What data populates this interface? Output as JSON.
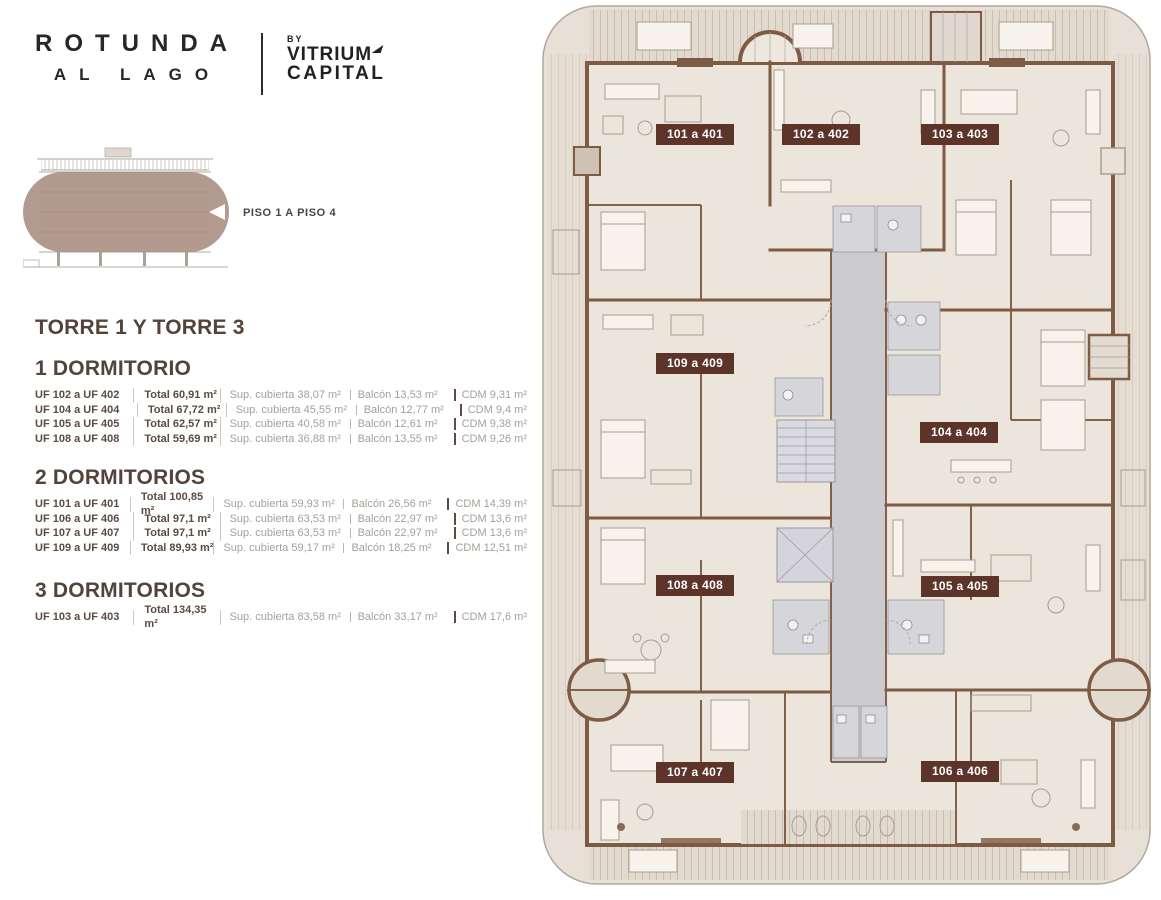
{
  "brand": {
    "name_line1": "ROTUNDA",
    "name_line2": "AL LAGO",
    "by": "BY",
    "partner_line1": "VITRIUM",
    "partner_line2": "CAPITAL"
  },
  "elevation": {
    "floor_range_label": "PISO 1 A PISO 4"
  },
  "tower_title": "TORRE 1 Y TORRE 3",
  "sections": [
    {
      "title": "1 DORMITORIO",
      "rows": [
        {
          "unit": "UF 102 a UF 402",
          "total": "Total 60,91 m²",
          "cubierta": "Sup. cubierta 38,07 m²",
          "balcon": "Balcón 13,53 m²",
          "cdm": "CDM 9,31 m²"
        },
        {
          "unit": "UF 104 a UF 404",
          "total": "Total 67,72 m²",
          "cubierta": "Sup. cubierta 45,55 m²",
          "balcon": "Balcón 12,77 m²",
          "cdm": "CDM 9,4 m²"
        },
        {
          "unit": "UF 105 a UF 405",
          "total": "Total 62,57 m²",
          "cubierta": "Sup. cubierta 40,58 m²",
          "balcon": "Balcón 12,61 m²",
          "cdm": "CDM 9,38 m²"
        },
        {
          "unit": "UF 108 a UF 408",
          "total": "Total 59,69 m²",
          "cubierta": "Sup. cubierta 36,88 m²",
          "balcon": "Balcón 13,55 m²",
          "cdm": "CDM 9,26 m²"
        }
      ]
    },
    {
      "title": "2 DORMITORIOS",
      "rows": [
        {
          "unit": "UF 101 a UF 401",
          "total": "Total 100,85 m²",
          "cubierta": "Sup. cubierta 59,93 m²",
          "balcon": "Balcón 26,56 m²",
          "cdm": "CDM 14,39 m²"
        },
        {
          "unit": "UF 106 a UF 406",
          "total": "Total 97,1 m²",
          "cubierta": "Sup. cubierta 63,53 m²",
          "balcon": "Balcón 22,97 m²",
          "cdm": "CDM 13,6 m²"
        },
        {
          "unit": "UF 107 a UF 407",
          "total": "Total 97,1 m²",
          "cubierta": "Sup. cubierta 63,53 m²",
          "balcon": "Balcón 22,97 m²",
          "cdm": "CDM 13,6 m²"
        },
        {
          "unit": "UF 109 a UF 409",
          "total": "Total 89,93 m²",
          "cubierta": "Sup. cubierta 59,17 m²",
          "balcon": "Balcón 18,25 m²",
          "cdm": "CDM 12,51 m²"
        }
      ]
    },
    {
      "title": "3 DORMITORIOS",
      "rows": [
        {
          "unit": "UF 103 a UF 403",
          "total": "Total 134,35 m²",
          "cubierta": "Sup. cubierta 83,58 m²",
          "balcon": "Balcón 33,17 m²",
          "cdm": "CDM 17,6 m²"
        }
      ]
    }
  ],
  "floorplan": {
    "units": [
      {
        "label": "101 a 401"
      },
      {
        "label": "102 a 402"
      },
      {
        "label": "103 a 403"
      },
      {
        "label": "109 a 409"
      },
      {
        "label": "104 a 404"
      },
      {
        "label": "108 a 408"
      },
      {
        "label": "105 a 405"
      },
      {
        "label": "107 a 407"
      },
      {
        "label": "106 a 406"
      }
    ]
  },
  "palette": {
    "badge": "#5d3429",
    "wall": "#7d5b45",
    "overlay": "#a88b7d",
    "corridor": "#cbcbd0",
    "heading": "#53433b",
    "text_dark": "#5b4b43",
    "text_muted": "#a5a098"
  }
}
